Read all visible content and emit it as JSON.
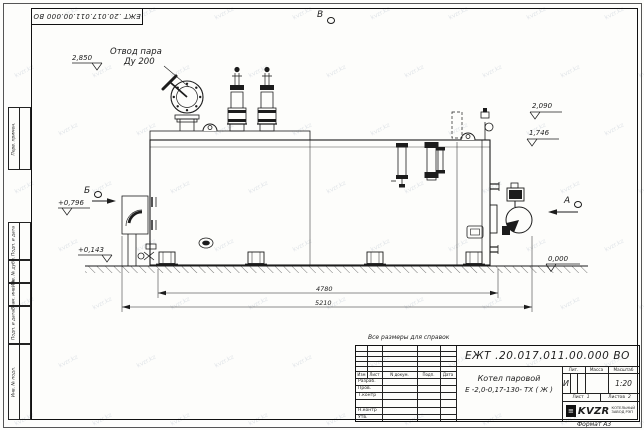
{
  "sheet": {
    "stamp_top": "ЕЖТ .20.017.011.00.000  ВО",
    "format_note": "Формат А3",
    "reference_note": "Все размеры для справок",
    "watermark": "kvzr.kz"
  },
  "margin_labels": {
    "perv": "Перв. примен.",
    "podp1": "Подп. и дата",
    "inv_dubl": "Инв. № дубл.",
    "vzam": "Взам. инв. №",
    "podp2": "Подп. и дата",
    "inv_podl": "Инв. № подл."
  },
  "annotations": {
    "steam_line1": "Отвод пара",
    "steam_line2": "Ду 200",
    "view_a": "А",
    "view_b": "Б",
    "view_v": "В",
    "elev_steam": "2,850",
    "elev_right_upper": "2,090",
    "elev_right_mid": "1,746",
    "elev_left_upper": "+0,796",
    "elev_left_lower": "+0,143",
    "elev_ground": "0,000",
    "dim_feet": "4780",
    "dim_overall": "5210"
  },
  "title_block": {
    "designation": "ЕЖТ .20.017.011.00.000  ВО",
    "product_line1": "Котел паровой",
    "product_line2": "Е -2,0-0,17-130- ТХ ( Ж )",
    "col_izm": "Изм",
    "col_list": "Лист",
    "col_doc": "N докум.",
    "col_sign": "Подп.",
    "col_date": "Дата",
    "role_develop": "Разраб.",
    "role_check": "Пров.",
    "role_tcontr": "Т.контр",
    "role_ncontr": "Н.контр",
    "role_approve": "Утв.",
    "lit_label": "Лит.",
    "mass_label": "Масса",
    "scale_label": "Масштаб",
    "lit_value": "И",
    "scale_value": "1:20",
    "sheet_label": "Лист",
    "sheet_value": "1",
    "sheets_label": "Листов",
    "sheets_value": "2",
    "logo": "KVZR",
    "company_line1": "КОТЕЛЬНЫЙ",
    "company_line2": "ЗАВОД РЭП"
  }
}
